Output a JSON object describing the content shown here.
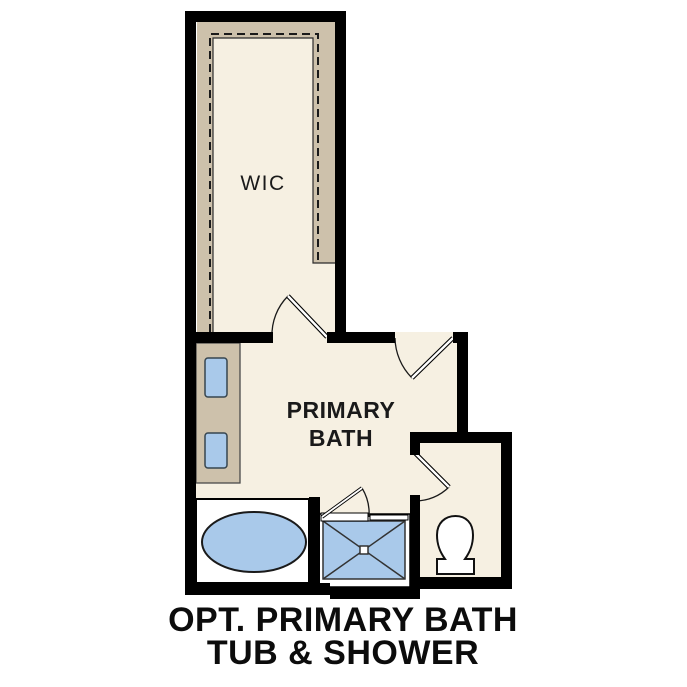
{
  "diagram": {
    "type": "floor-plan",
    "caption": {
      "line1": "OPT. PRIMARY BATH",
      "line2": "TUB & SHOWER"
    },
    "rooms": [
      {
        "id": "wic",
        "name": "walk-in closet",
        "label": "WIC"
      },
      {
        "id": "primary-bath",
        "name": "primary bathroom",
        "label_line1": "PRIMARY",
        "label_line2": "BATH"
      },
      {
        "id": "water-closet",
        "name": "water closet",
        "label": ""
      }
    ],
    "fixtures": [
      "double-sink vanity",
      "soaking tub",
      "walk-in shower with glass door",
      "toilet"
    ],
    "doors": [
      "wic-door",
      "bath-entry-door",
      "water-closet-door",
      "shower-door"
    ],
    "colors": {
      "wall": "#000000",
      "floor": "#f6f0e2",
      "casework_tan": "#cdc1ab",
      "fixture_blue": "#a9c9ea",
      "fixture_white": "#ffffff",
      "page_background": "#ffffff"
    }
  }
}
